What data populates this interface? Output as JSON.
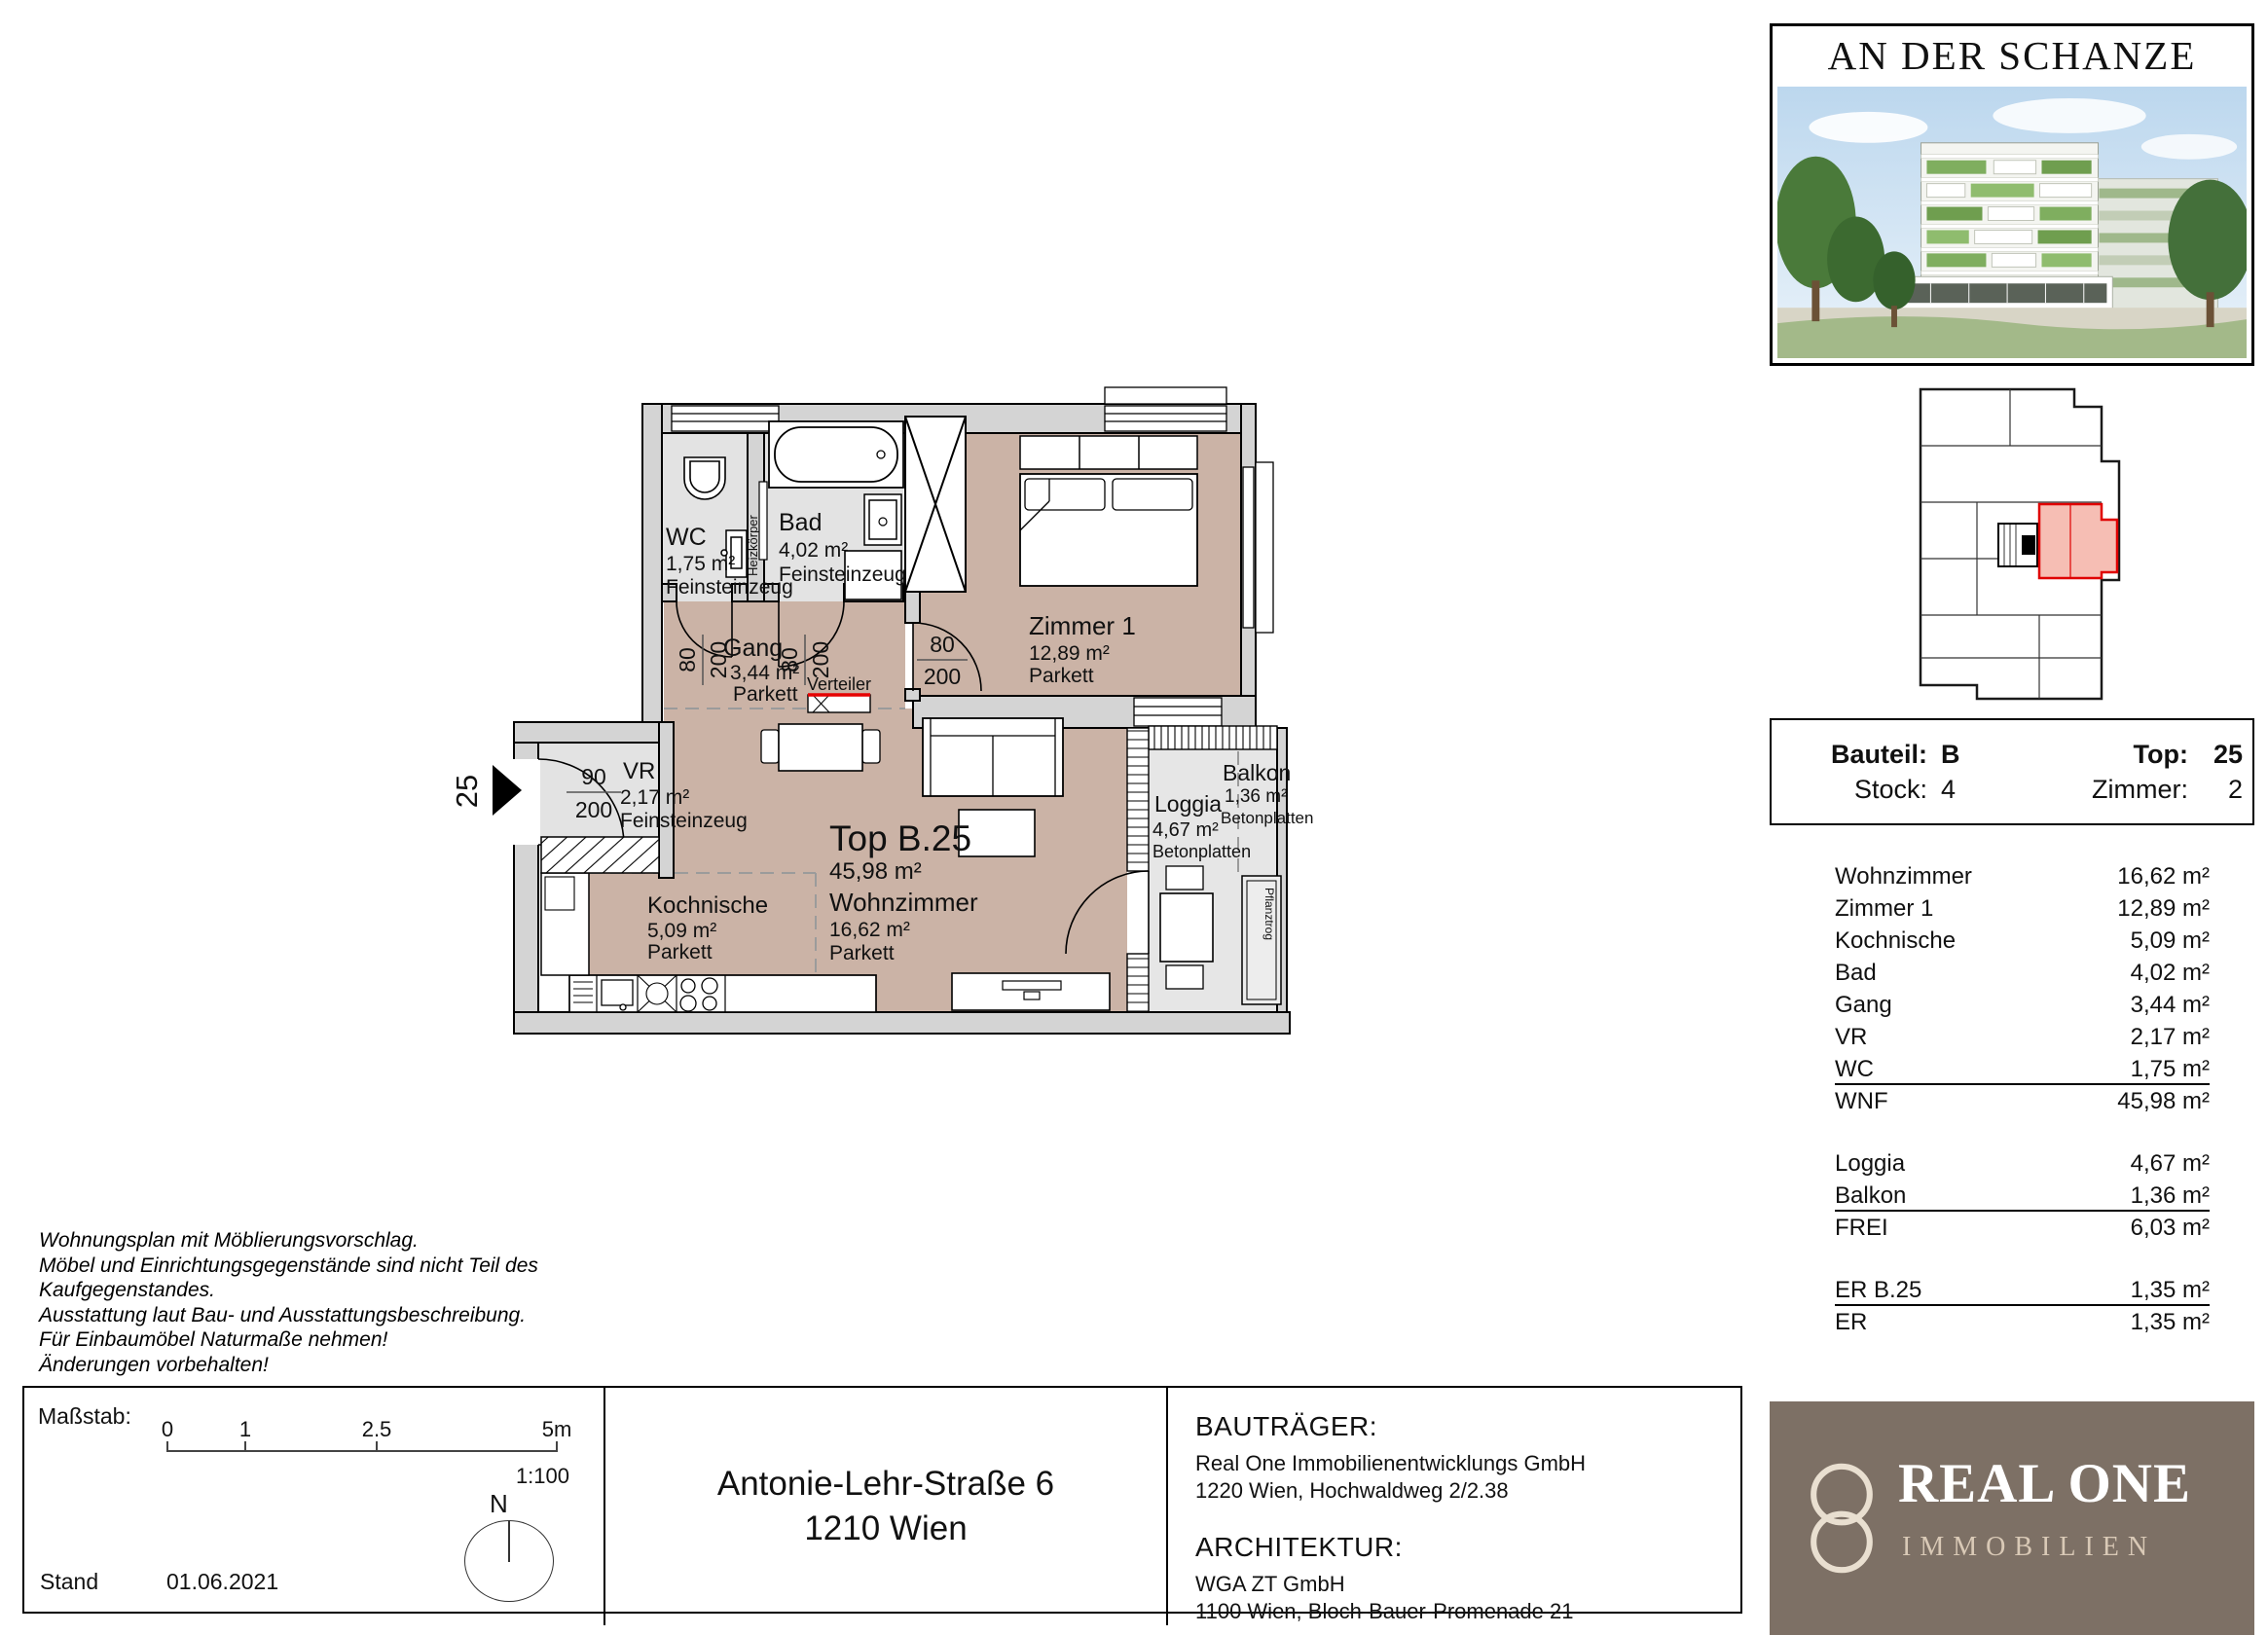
{
  "project": {
    "title": "AN DER SCHANZE"
  },
  "plan": {
    "entrance_number": "25",
    "top_label": "Top B.25",
    "top_area": "45,98 m²",
    "rooms": {
      "wc": {
        "name": "WC",
        "area": "1,75 m²",
        "floor": "Feinsteinzeug"
      },
      "bad": {
        "name": "Bad",
        "area": "4,02 m²",
        "floor": "Feinsteinzeug"
      },
      "gang": {
        "name": "Gang",
        "area": "3,44 m²",
        "floor": "Parkett"
      },
      "zimmer1": {
        "name": "Zimmer 1",
        "area": "12,89 m²",
        "floor": "Parkett"
      },
      "vr": {
        "name": "VR",
        "area": "2,17 m²",
        "floor": "Feinsteinzeug"
      },
      "kochnische": {
        "name": "Kochnische",
        "area": "5,09 m²",
        "floor": "Parkett"
      },
      "wohnzimmer": {
        "name": "Wohnzimmer",
        "area": "16,62 m²",
        "floor": "Parkett"
      },
      "loggia": {
        "name": "Loggia",
        "area": "4,67 m²",
        "floor": "Betonplatten"
      },
      "balkon": {
        "name": "Balkon",
        "area": "1,36 m²",
        "floor": "Betonplatten"
      }
    },
    "labels": {
      "verteiler": "Verteiler",
      "heizkoerper": "Heizkörper",
      "pflanztrog": "Pflanztrog"
    },
    "dims": {
      "d80": "80",
      "d90": "90",
      "d200": "200"
    }
  },
  "sidebar": {
    "info": {
      "bauteil_label": "Bauteil:",
      "bauteil_value": "B",
      "top_label": "Top:",
      "top_value": "25",
      "stock_label": "Stock:",
      "stock_value": "4",
      "zimmer_label": "Zimmer:",
      "zimmer_value": "2"
    },
    "area_table": {
      "rows": [
        {
          "label": "Wohnzimmer",
          "value": "16,62 m²"
        },
        {
          "label": "Zimmer 1",
          "value": "12,89 m²"
        },
        {
          "label": "Kochnische",
          "value": "5,09 m²"
        },
        {
          "label": "Bad",
          "value": "4,02 m²"
        },
        {
          "label": "Gang",
          "value": "3,44 m²"
        },
        {
          "label": "VR",
          "value": "2,17 m²"
        },
        {
          "label": "WC",
          "value": "1,75 m²"
        },
        {
          "label": "WNF",
          "value": "45,98 m²"
        },
        {
          "label": "Loggia",
          "value": "4,67 m²"
        },
        {
          "label": "Balkon",
          "value": "1,36 m²"
        },
        {
          "label": "FREI",
          "value": "6,03 m²"
        },
        {
          "label": "ER B.25",
          "value": "1,35 m²"
        },
        {
          "label": "ER",
          "value": "1,35 m²"
        }
      ]
    },
    "logo": {
      "name": "REAL ONE",
      "subtitle": "IMMOBILIEN"
    }
  },
  "footer": {
    "disclaimer_lines": [
      "Wohnungsplan mit Möblierungsvorschlag.",
      "Möbel und Einrichtungsgegenstände sind nicht Teil des",
      "Kaufgegenstandes.",
      "Ausstattung laut Bau- und Ausstattungsbeschreibung.",
      "Für Einbaumöbel Naturmaße nehmen!",
      "Änderungen vorbehalten!"
    ],
    "massstab_label": "Maßstab:",
    "scale_ticks": [
      "0",
      "1",
      "2.5",
      "5m"
    ],
    "scale_ratio": "1:100",
    "north_label": "N",
    "stand_label": "Stand",
    "stand_date": "01.06.2021",
    "address_line1": "Antonie-Lehr-Straße 6",
    "address_line2": "1210 Wien",
    "bautraeger_heading": "BAUTRÄGER:",
    "bautraeger_lines": [
      "Real One Immobilienentwicklungs GmbH",
      "1220 Wien, Hochwaldweg 2/2.38"
    ],
    "architektur_heading": "ARCHITEKTUR:",
    "architektur_lines": [
      "WGA ZT GmbH",
      "1100 Wien, Bloch-Bauer-Promenade 21"
    ]
  },
  "colors": {
    "accent_red": "#e60000",
    "room_rose": "#cbb3a6",
    "room_gray": "#e3e3e3",
    "wall_gray": "#d4d4d4",
    "logo_bg": "#7d7065"
  }
}
